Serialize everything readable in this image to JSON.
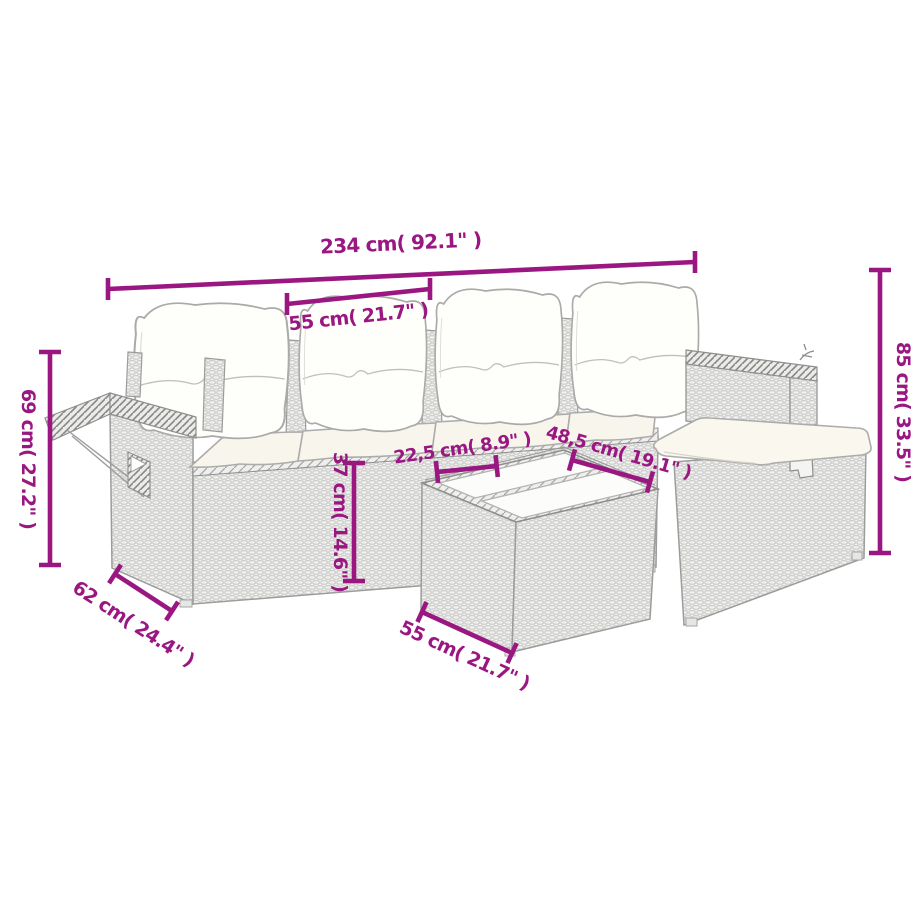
{
  "page": {
    "background": "#FFFFFF"
  },
  "diagram": {
    "accent_color": "#9A1782",
    "drawing_line_color": "#9C9C9A",
    "cushion_color": "#FDFCF7",
    "labels": {
      "overall_width": "234 cm( 92.1\" )",
      "seat_width": "55 cm( 21.7\" )",
      "left_height": "69 cm( 27.2\" )",
      "right_height": "85 cm( 33.5\" )",
      "seat_height": "37 cm( 14.6\" )",
      "inner_width": "22,5 cm( 8.9\" )",
      "table_length": "48,5 cm( 19.1\" )",
      "side_depth": "62 cm( 24.4\" )",
      "table_depth": "55 cm( 21.7\" )"
    }
  }
}
